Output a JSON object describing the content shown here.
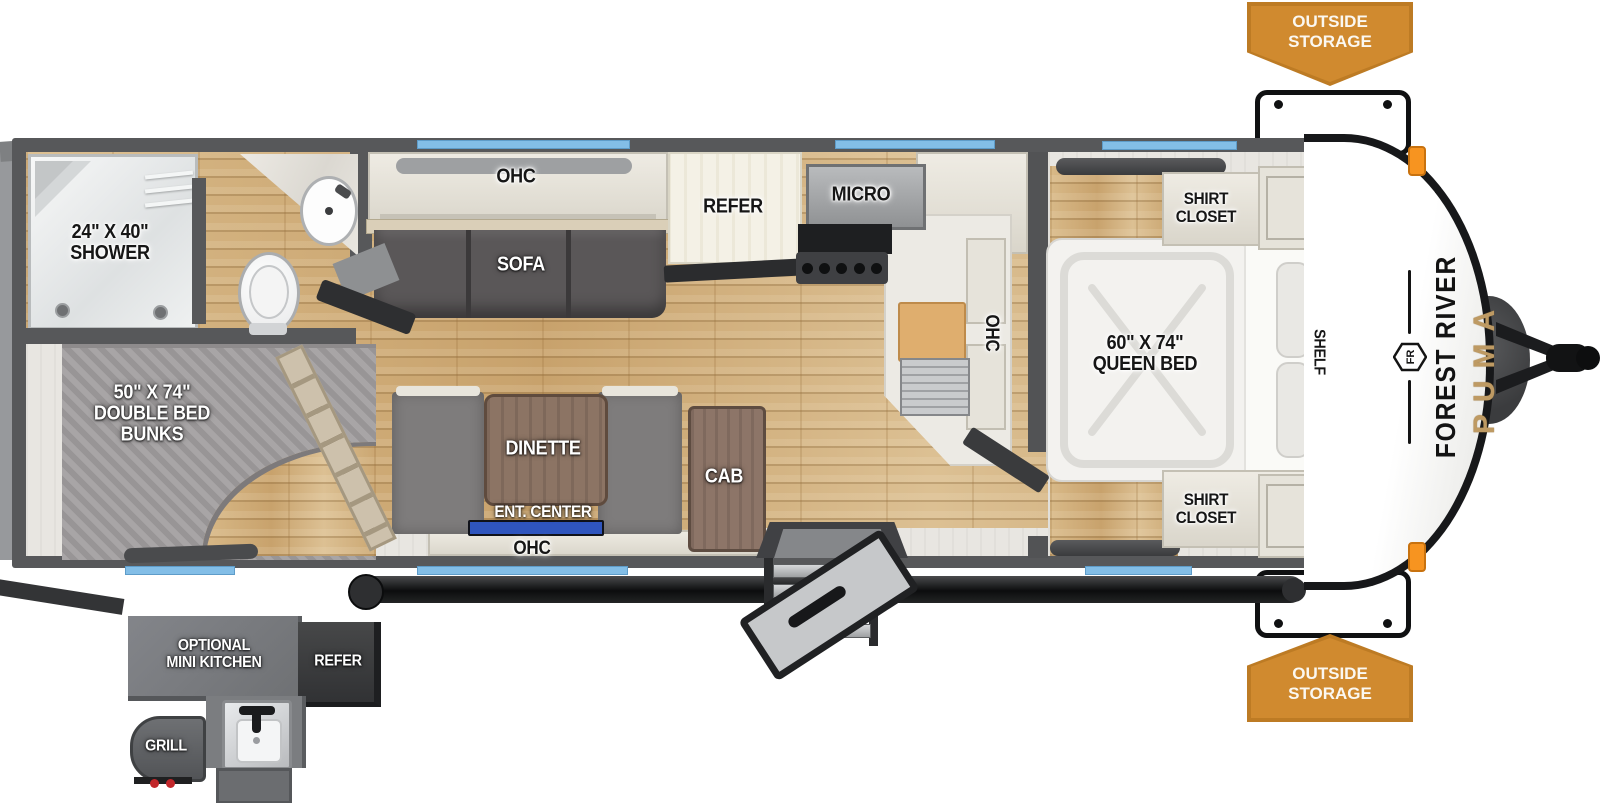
{
  "banner_top": {
    "line1": "OUTSIDE",
    "line2": "STORAGE"
  },
  "banner_bottom": {
    "line1": "OUTSIDE",
    "line2": "STORAGE"
  },
  "bathroom": {
    "shower_size": "24\" X 40\"",
    "shower": "SHOWER"
  },
  "bunk_room": {
    "size": "50\" X 74\"",
    "name1": "DOUBLE BED",
    "name2": "BUNKS"
  },
  "living": {
    "ohc_sofa": "OHC",
    "sofa": "SOFA",
    "refer": "REFER",
    "micro": "MICRO",
    "ohc_kitchen": "OHC",
    "dinette": "DINETTE",
    "ent_center": "ENT. CENTER",
    "cab": "CAB",
    "ohc_dinette": "OHC"
  },
  "bedroom": {
    "bed_size": "60\" X 74\"",
    "bed_name": "QUEEN BED",
    "shirt_closet1": "SHIRT",
    "shirt_closet2": "CLOSET",
    "shelf": "SHELF"
  },
  "brand": {
    "logo": "FR",
    "maker": "FOREST RIVER",
    "model": "PUMA"
  },
  "outside_kitchen": {
    "title1": "OPTIONAL",
    "title2": "MINI KITCHEN",
    "refer": "REFER",
    "grill": "GRILL"
  },
  "colors": {
    "banner_orange": "#D08A2F",
    "banner_border": "#BD7B24",
    "window_blue": "#83BEE7",
    "wall_gray": "#57585A",
    "wood_floor": "#D2B17E",
    "puma_gold": "#BE9A63",
    "tv_blue": "#2F55BE"
  }
}
